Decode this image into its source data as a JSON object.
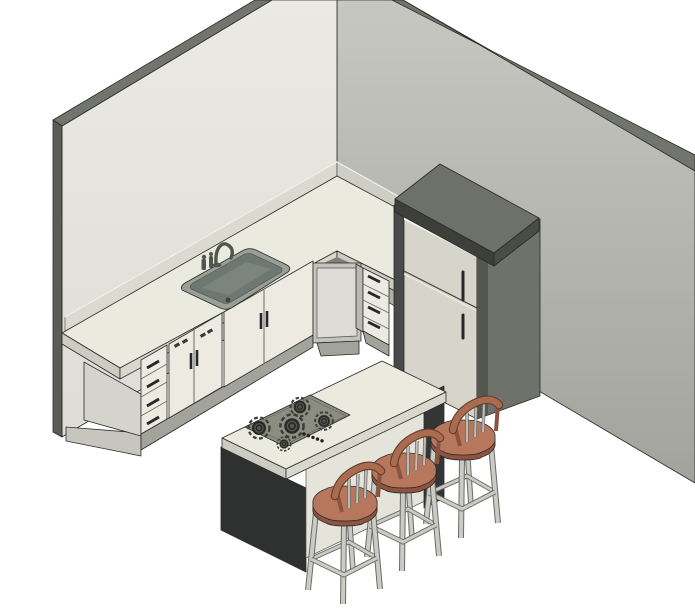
{
  "scene": {
    "stools": 3,
    "cooktop_burners": 5,
    "cooktop_knobs": 5,
    "refrigerator_doors": 2,
    "refrigerator_handles": 2,
    "cabinet_drawers_left": 4,
    "cabinet_drawers_corner": 4,
    "sink_basins": 1
  },
  "colors": {
    "background": "#ffffff",
    "outline": "#2b2b28",
    "wall_left_top": "#ebeae2",
    "wall_left_bottom": "#deddd5",
    "wall_right_top": "#c6c7c1",
    "wall_right_bottom": "#a2a39d",
    "wall_top_band": "#72746e",
    "wall_end_cap": "#5a5c58",
    "splash_left": "#dbdad1",
    "splash_right": "#cfcec5",
    "splash_lip": "#f2f1ea",
    "counter_top": "#ebeade",
    "counter_edge": "#cdccc3",
    "counter_edge_light": "#d9d8cd",
    "counter_underside": "#7f8078",
    "cabinet_front": "#edebe1",
    "cabinet_side": "#d4d4cd",
    "cabinet_base": "#c6c6bf",
    "cabinet_kick": "#a2a39b",
    "cabinet_frame": "#c4c3bb",
    "corner_door": "#dcdbd4",
    "stack_side": "#b9b8b1",
    "divider": "#6b6c64",
    "handle": "#26272a",
    "button": "#3a3b35",
    "sink_rim": "#999e97",
    "sink_basin": "#6e7872",
    "sink_basin_floor": "#7b857d",
    "sink_drain": "#3d443f",
    "faucet": "#4f5551",
    "fridge_front": "#d6d5cb",
    "fridge_highlight": "#f4f4ec",
    "fridge_side": "#6f716b",
    "fridge_side_shade": "#54564f",
    "fridge_top": "#6e706a",
    "fridge_trim_dark": "#3d3f3b",
    "fridge_trim": "#4a4c46",
    "fridge_left_edge": "#47494b",
    "door_gap_dark": "#43443f",
    "door_gap_light": "#efeee6",
    "island_end_panel": "#2f3030",
    "island_end_panel_far": "#343535",
    "island_face": "#e5e4db",
    "island_face_shadow": "#c6c5bc",
    "cooktop": "#8b8d81",
    "cooktop_border": "#6c6d63",
    "burner_dark": "#2a2b26",
    "burner_ring": "#3c3d36",
    "burner_center": "#5a5a52",
    "knob": "#22231f",
    "stool_seat": "#b7775c",
    "stool_seat_edge": "#8e5440",
    "stool_rail": "#aa6c50",
    "stool_rail_edge": "#6b3f2d",
    "stool_post": "#8a5340",
    "stool_spindle": "#c2bfb9",
    "stool_spindle_edge": "#6a6a65",
    "stool_leg": "#cbcbc5",
    "stool_leg_edge": "#6a6a65"
  }
}
